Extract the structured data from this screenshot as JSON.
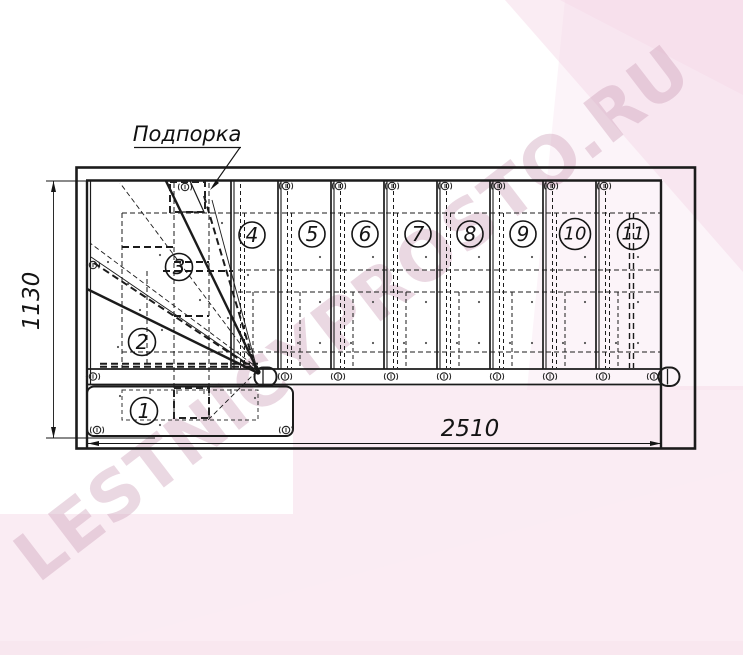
{
  "drawing": {
    "support_label": "Подпорка",
    "dim_height": "1130",
    "dim_width": "2510",
    "steps": [
      "1",
      "2",
      "3",
      "4",
      "5",
      "6",
      "7",
      "8",
      "9",
      "10",
      "11"
    ]
  },
  "watermark": {
    "text": "LESTNICYPROSTO.RU",
    "pink": "#f6d9e8",
    "pink_light": "#fbecf4",
    "letter_color": "#cfa3bb"
  },
  "icons": {
    "screw": "circle-with-slot-and-side-arcs"
  },
  "colors": {
    "line": "#1b1b1b",
    "background": "#ffffff"
  }
}
